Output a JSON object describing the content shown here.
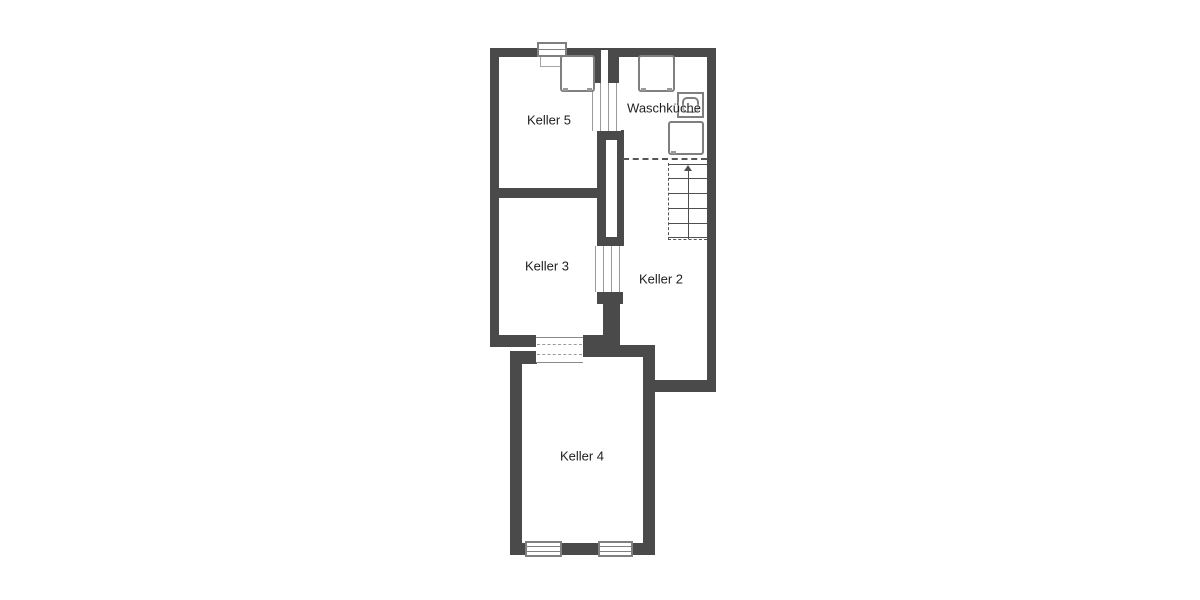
{
  "plan": {
    "type": "floor-plan",
    "rooms": [
      {
        "id": "keller-5",
        "label": "Keller 5"
      },
      {
        "id": "waschkueche",
        "label": "Waschküche"
      },
      {
        "id": "keller-3",
        "label": "Keller 3"
      },
      {
        "id": "keller-2",
        "label": "Keller 2"
      },
      {
        "id": "keller-4",
        "label": "Keller 4"
      }
    ],
    "features": [
      "stairs-up",
      "washing-machine",
      "sink",
      "appliance",
      "windows",
      "door-openings",
      "shaft"
    ],
    "colors": {
      "wall": "#4a4a4a",
      "background": "#ffffff",
      "fixture_line": "#7f7f7f",
      "dash": "#555555",
      "text": "#1e1e1e",
      "thin": "#4f4f4f"
    }
  }
}
